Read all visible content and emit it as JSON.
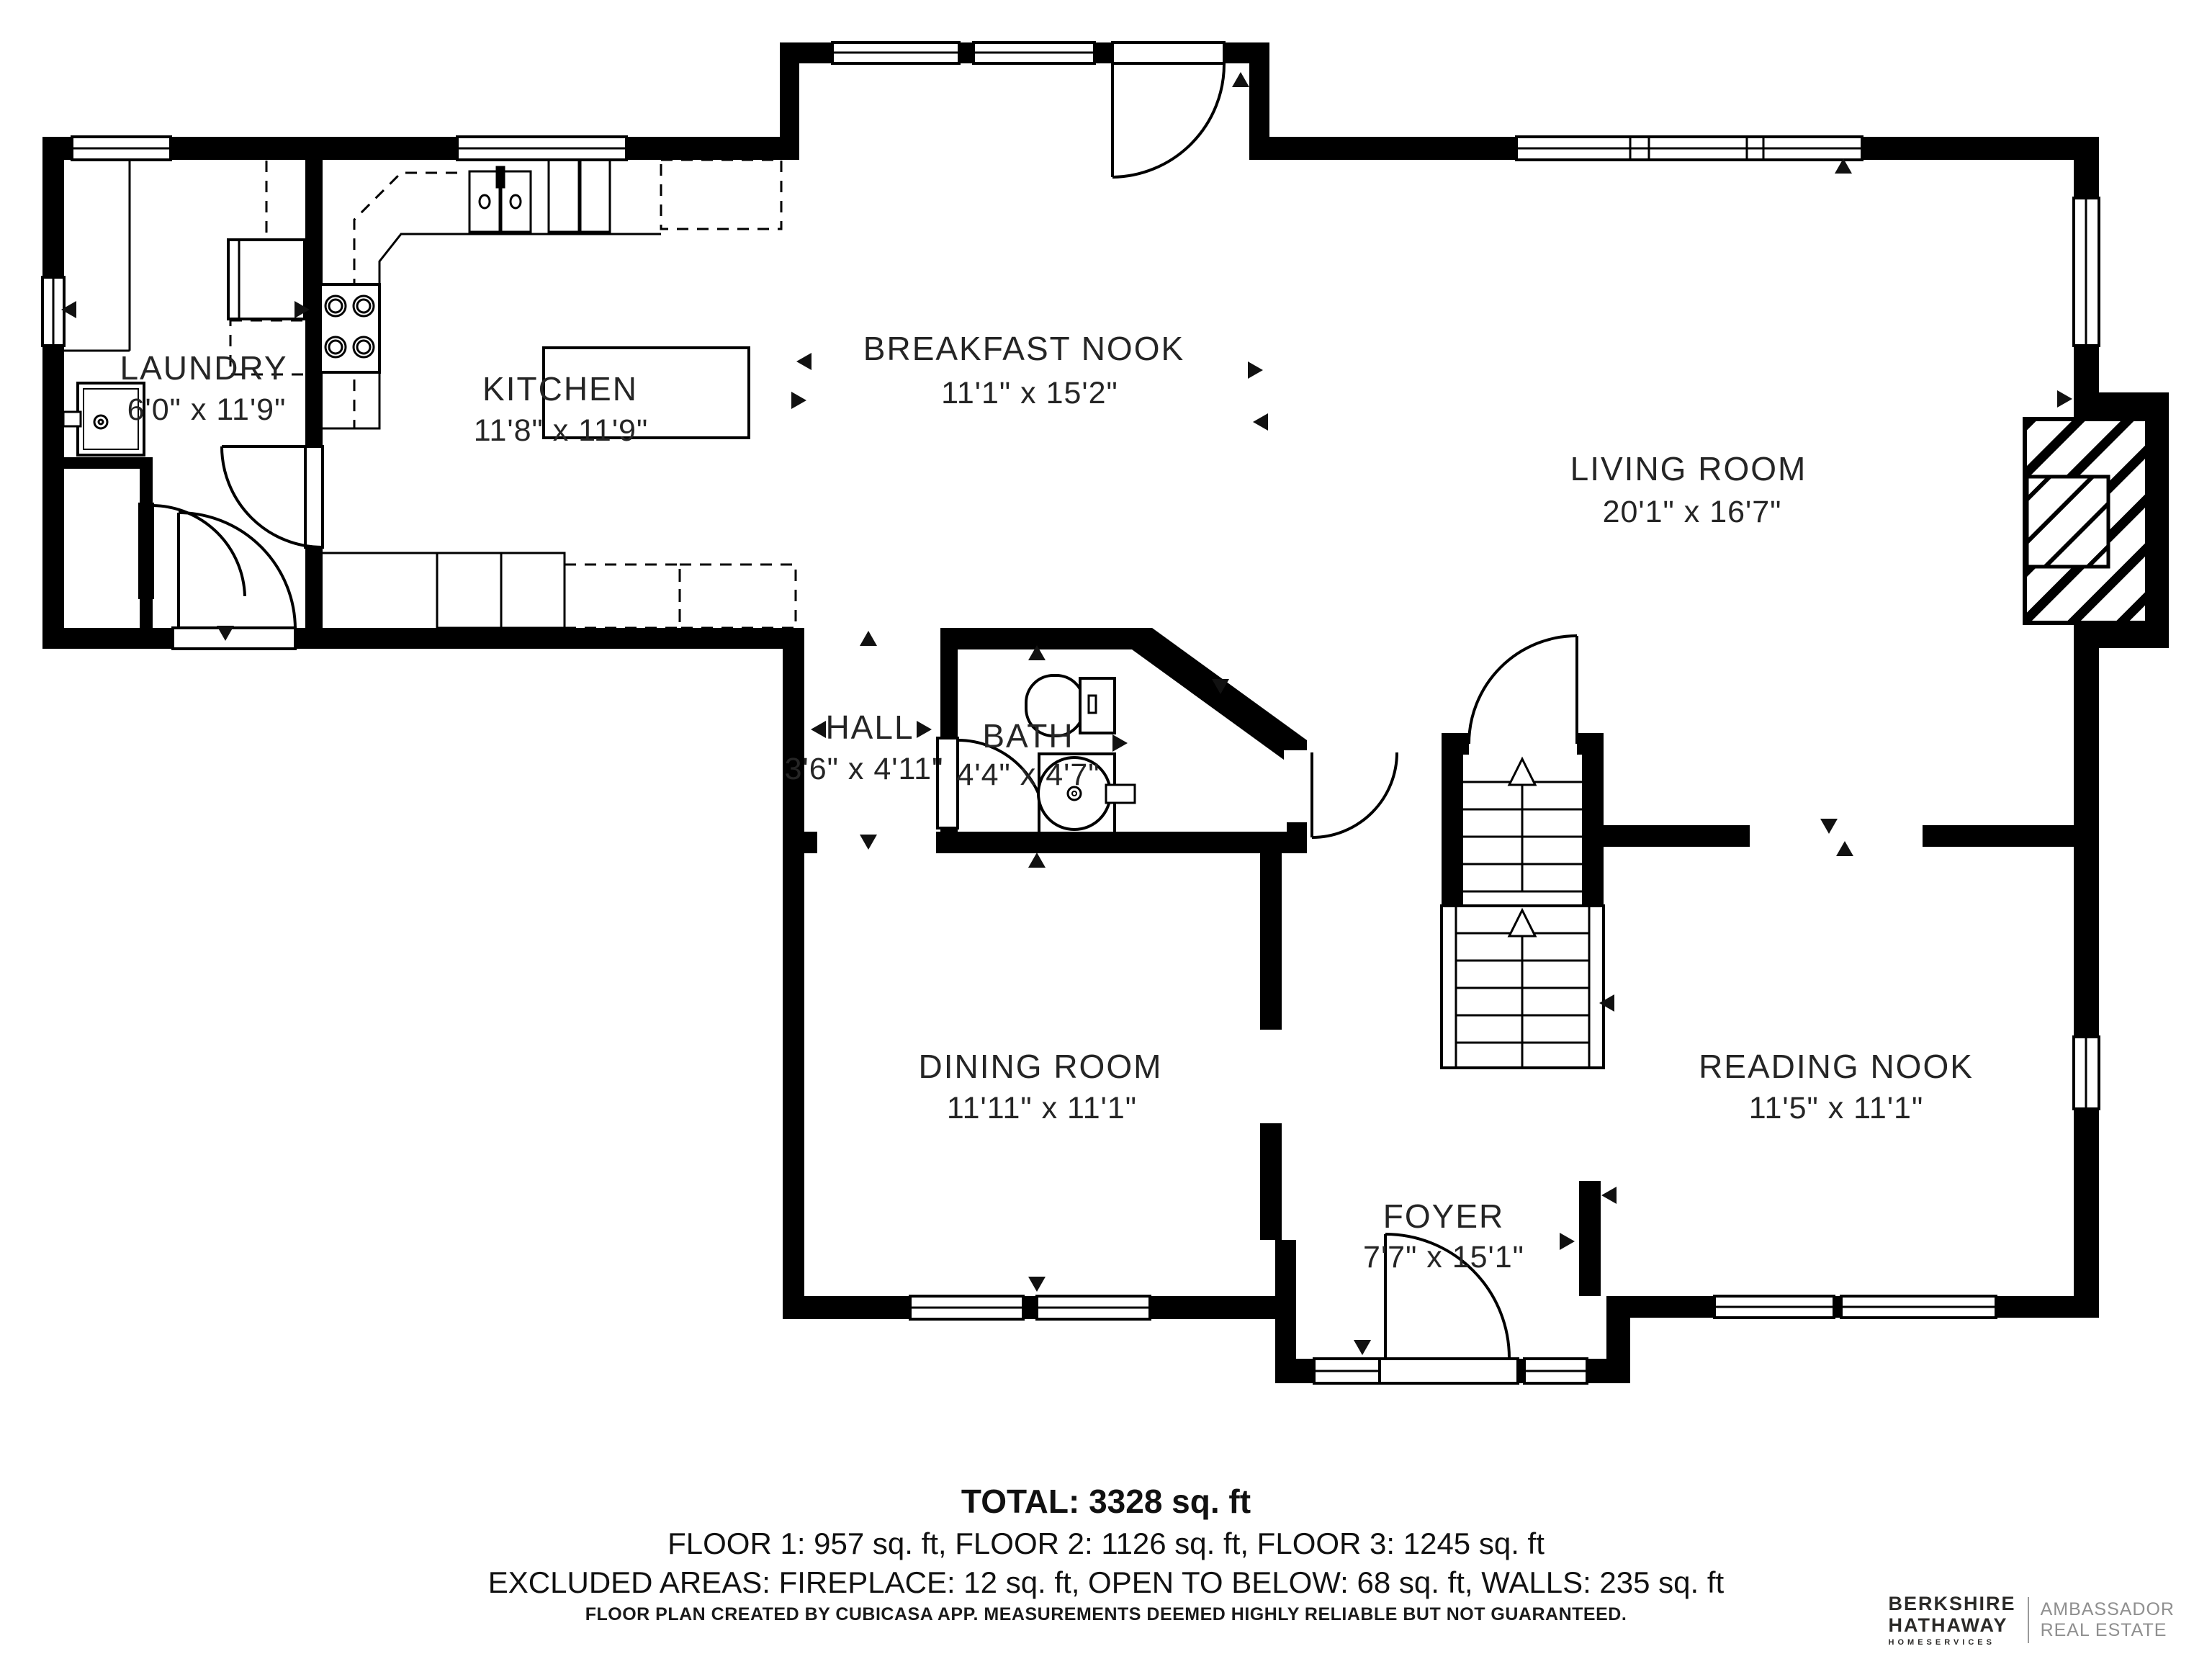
{
  "rooms": {
    "laundry": {
      "name": "LAUNDRY",
      "dims": "6'0\" x 11'9\""
    },
    "kitchen": {
      "name": "KITCHEN",
      "dims": "11'8\" x 11'9\""
    },
    "breakfast_nook": {
      "name": "BREAKFAST NOOK",
      "dims": "11'1\" x 15'2\""
    },
    "living_room": {
      "name": "LIVING ROOM",
      "dims": "20'1\" x 16'7\""
    },
    "hall": {
      "name": "HALL",
      "dims": "3'6\" x 4'11\""
    },
    "bath": {
      "name": "BATH",
      "dims": "4'4\" x 4'7\""
    },
    "dining_room": {
      "name": "DINING ROOM",
      "dims": "11'11\" x 11'1\""
    },
    "reading_nook": {
      "name": "READING NOOK",
      "dims": "11'5\" x 11'1\""
    },
    "foyer": {
      "name": "FOYER",
      "dims": "7'7\" x 15'1\""
    }
  },
  "summary": {
    "total": "TOTAL: 3328 sq. ft",
    "floors": "FLOOR 1: 957 sq. ft, FLOOR 2: 1126 sq. ft, FLOOR 3: 1245 sq. ft",
    "excluded": "EXCLUDED AREAS: FIREPLACE: 12 sq. ft, OPEN TO BELOW: 68 sq. ft, WALLS: 235 sq. ft"
  },
  "disclaimer": "FLOOR PLAN CREATED BY CUBICASA APP. MEASUREMENTS DEEMED HIGHLY RELIABLE BUT NOT GUARANTEED.",
  "brand": {
    "line1": "BERKSHIRE",
    "line2": "HATHAWAY",
    "line3": "HOMESERVICES",
    "right1": "AMBASSADOR",
    "right2": "REAL ESTATE"
  },
  "colors": {
    "wall": "#000000",
    "background": "#ffffff",
    "label": "#252525",
    "brand_dark": "#2b2a28",
    "brand_gray": "#8f8f8f"
  }
}
